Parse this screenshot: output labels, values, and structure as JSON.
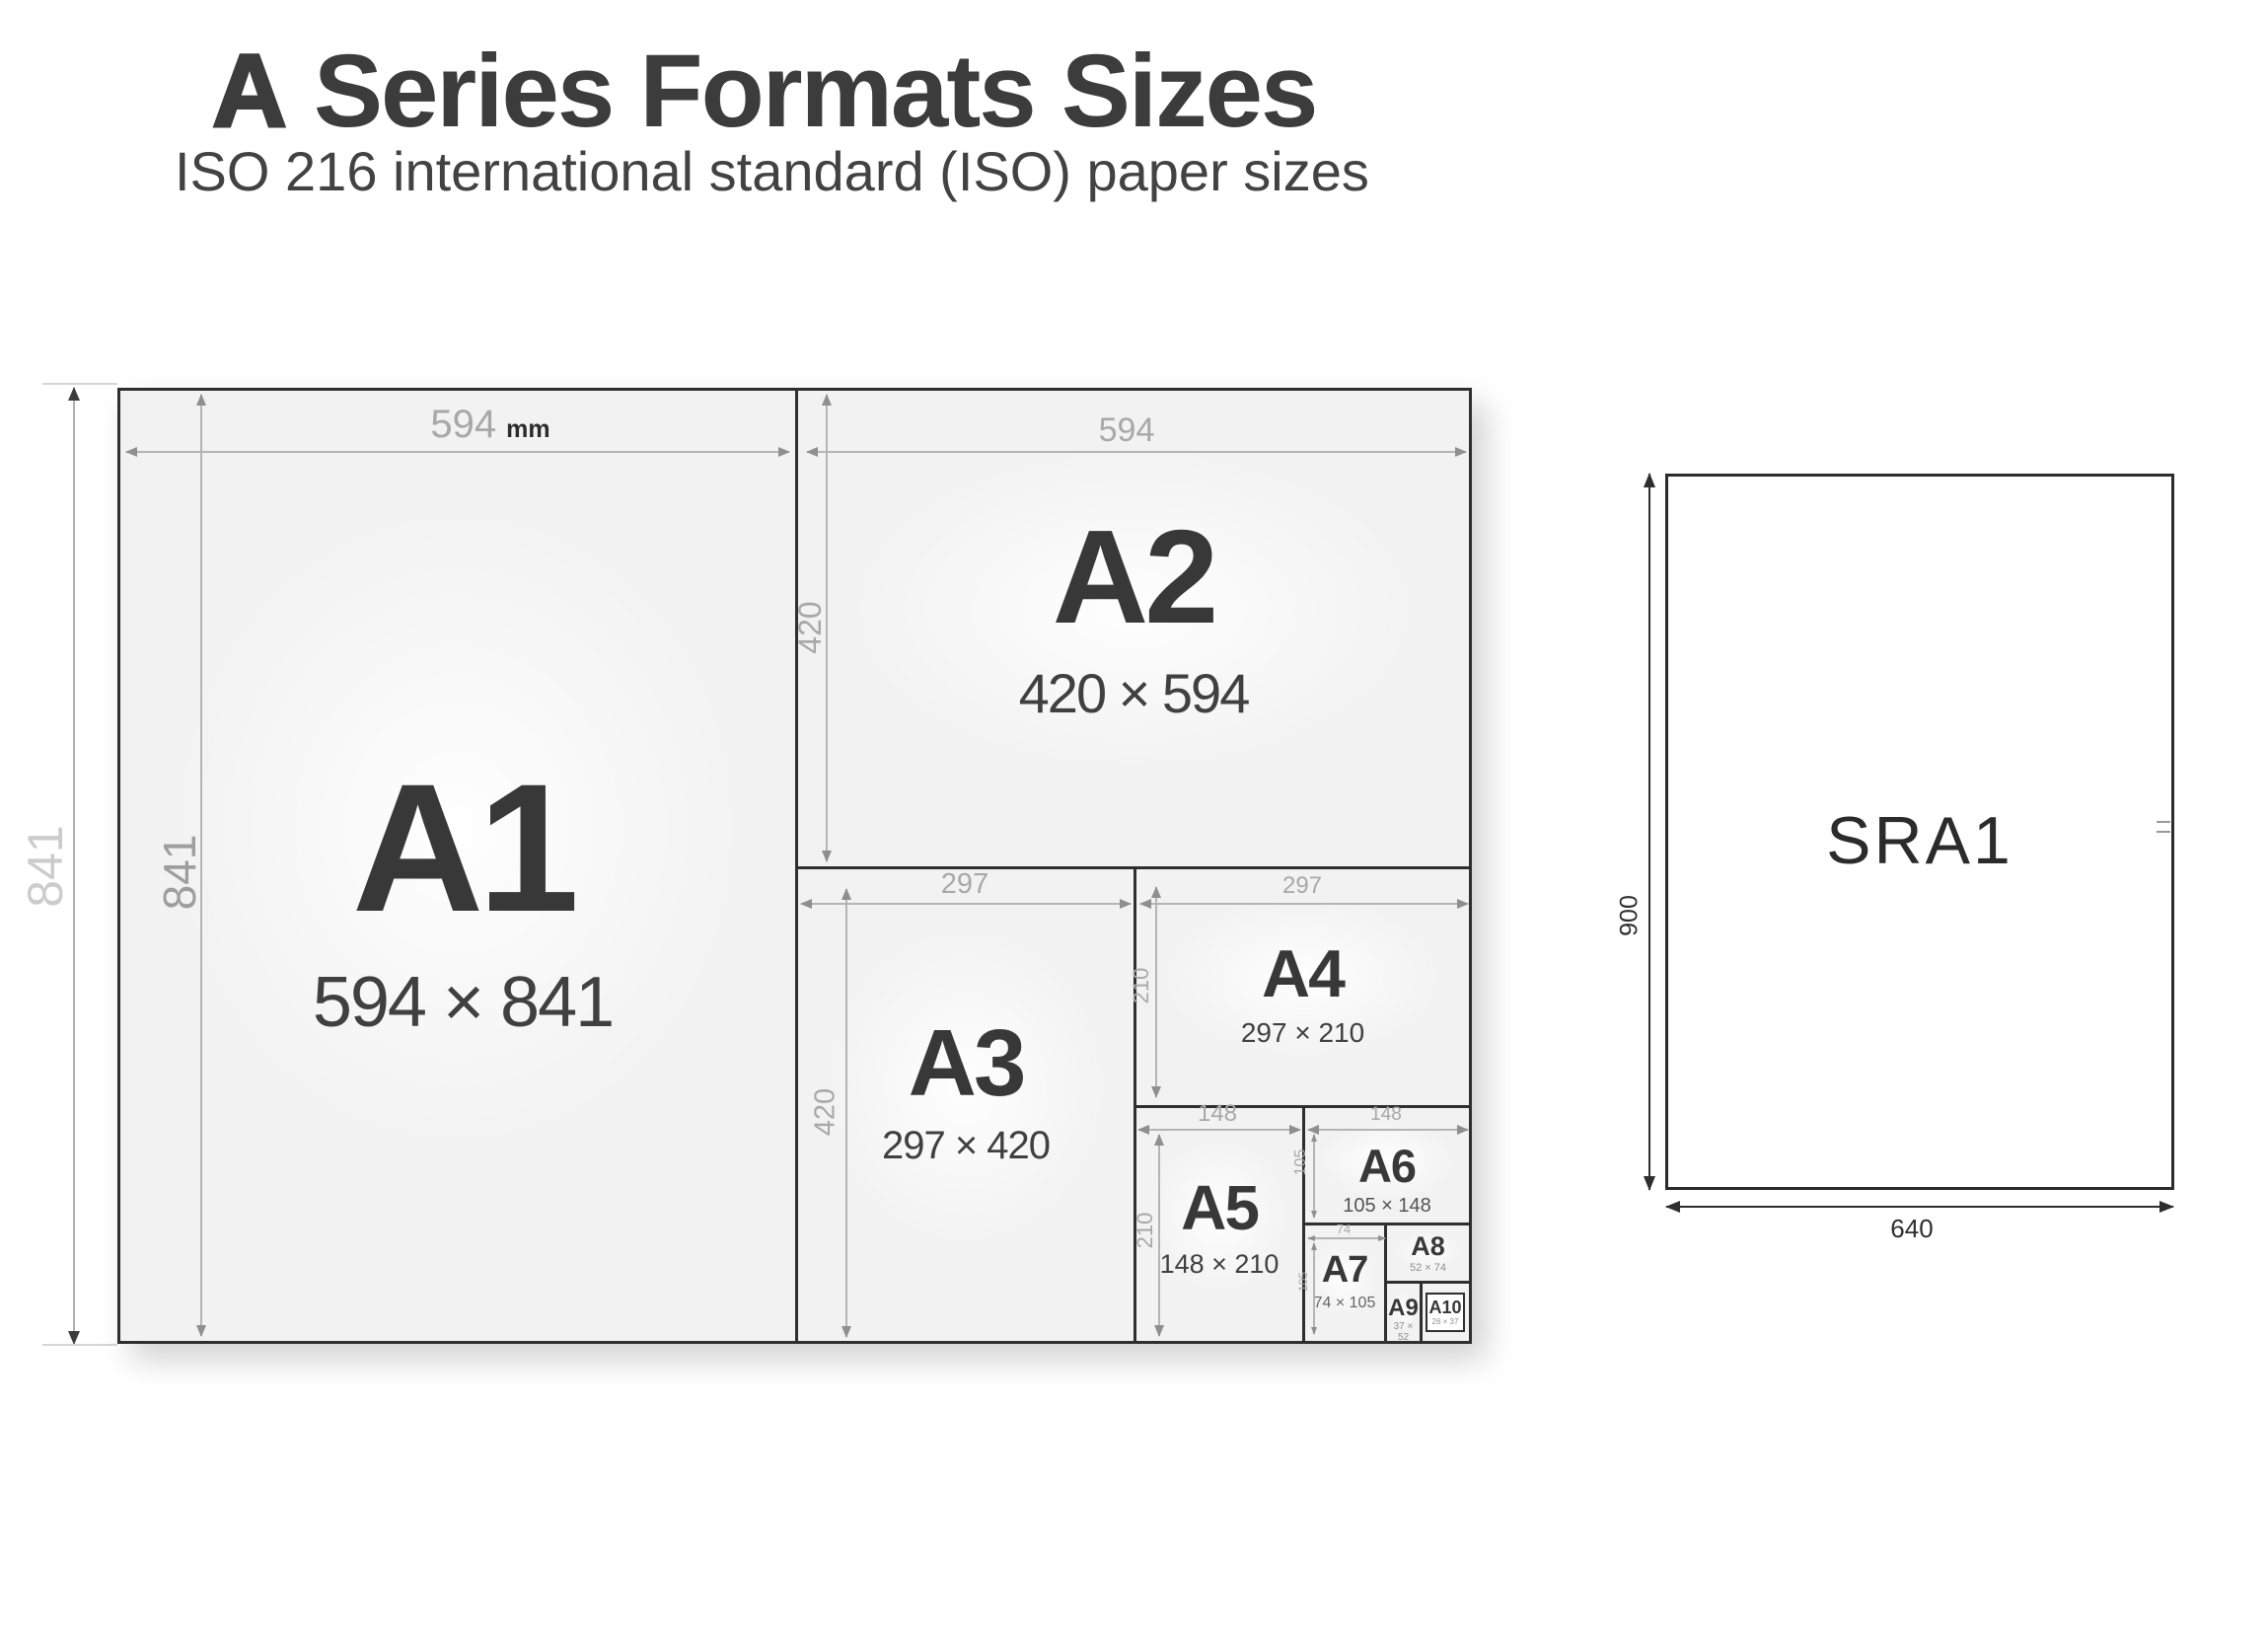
{
  "header": {
    "title_accent": "A",
    "title_rest": " Series Formats Sizes",
    "subtitle": "ISO 216 international standard (ISO) paper sizes"
  },
  "diagram": {
    "unit": "mm",
    "a1": {
      "label": "A1",
      "size": "594 × 841",
      "width": "594",
      "height": "841"
    },
    "a2": {
      "label": "A2",
      "size": "420 × 594",
      "width": "594",
      "height": "420"
    },
    "a3": {
      "label": "A3",
      "size": "297 × 420",
      "width": "297",
      "height": "420"
    },
    "a4": {
      "label": "A4",
      "size": "297 × 210",
      "width": "297",
      "height": "210"
    },
    "a5": {
      "label": "A5",
      "size": "148 × 210",
      "width": "148",
      "height": "210"
    },
    "a6": {
      "label": "A6",
      "size": "105 × 148",
      "width": "148",
      "height": "105"
    },
    "a7": {
      "label": "A7",
      "size": "74 × 105",
      "width": "74",
      "height": "105"
    },
    "a8": {
      "label": "A8",
      "size": "52 × 74"
    },
    "a9": {
      "label": "A9",
      "size": "37 × 52"
    },
    "a10": {
      "label": "A10",
      "size": "26 × 37"
    }
  },
  "sra": {
    "label": "SRA1",
    "width": "640",
    "height": "900"
  },
  "colors": {
    "text_dark": "#3c3c3c",
    "dim_gray": "#a8a8a8",
    "sheet_fill": "#f2f2f2",
    "border": "#2f2f2f"
  }
}
